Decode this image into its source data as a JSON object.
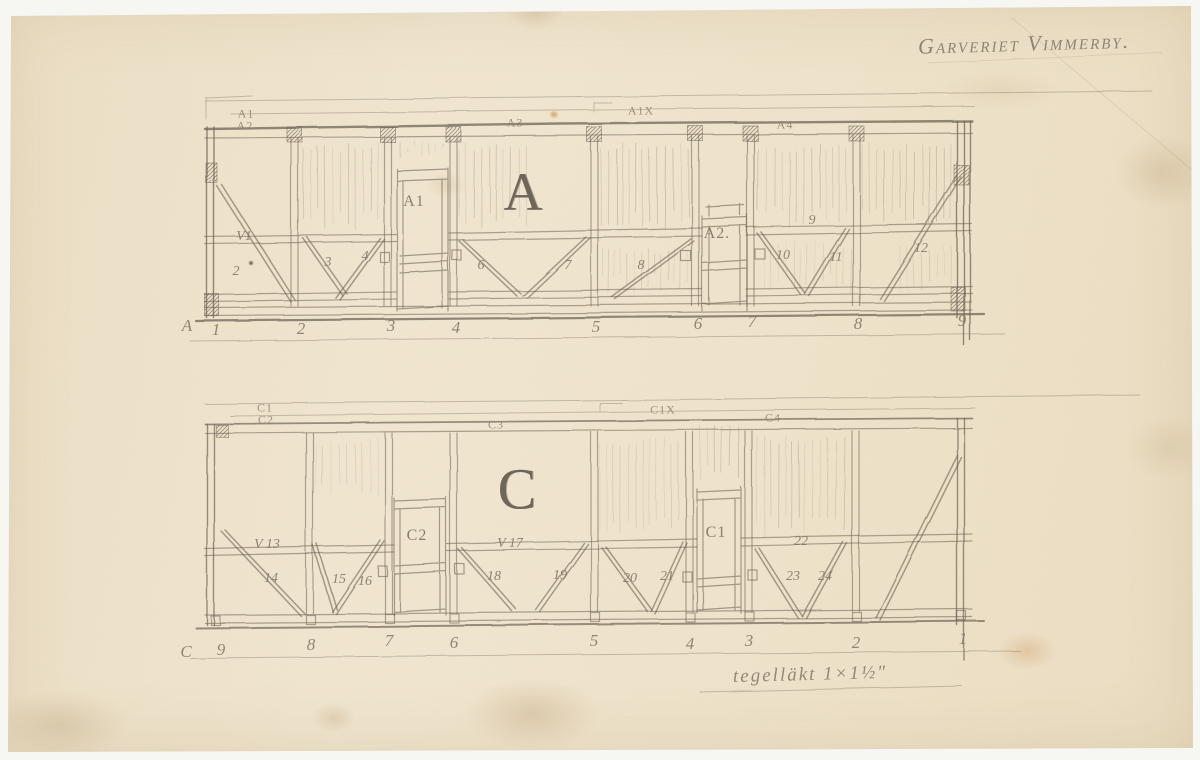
{
  "document": {
    "title": "Garveriet Vimmerby.",
    "annotation": "tegelläkt 1×1½″",
    "colors": {
      "paper": "#efe3cb",
      "pencil": "#6f6557",
      "background": "#f6f6f3"
    }
  },
  "elevation_a": {
    "big_letter": "A",
    "top_labels": [
      {
        "text": "A1",
        "x": 246,
        "y": 114
      },
      {
        "text": "A2",
        "x": 245,
        "y": 126
      },
      {
        "text": "A3",
        "x": 515,
        "y": 123
      },
      {
        "text": "A1X",
        "x": 641,
        "y": 111
      },
      {
        "text": "A4",
        "x": 785,
        "y": 125
      }
    ],
    "door_labels": [
      {
        "text": "A1",
        "x": 414,
        "y": 202
      },
      {
        "text": "A2.",
        "x": 717,
        "y": 234
      }
    ],
    "panel_labels": [
      {
        "text": "V1",
        "x": 244,
        "y": 237
      },
      {
        "text": "2",
        "x": 236,
        "y": 272
      },
      {
        "text": "3",
        "x": 328,
        "y": 263
      },
      {
        "text": "4",
        "x": 365,
        "y": 257
      },
      {
        "text": "6",
        "x": 481,
        "y": 266
      },
      {
        "text": "7",
        "x": 568,
        "y": 266
      },
      {
        "text": "8",
        "x": 641,
        "y": 266
      },
      {
        "text": "9",
        "x": 812,
        "y": 221
      },
      {
        "text": "10",
        "x": 783,
        "y": 256
      },
      {
        "text": "11",
        "x": 836,
        "y": 258
      },
      {
        "text": "12",
        "x": 921,
        "y": 249
      }
    ],
    "grid_labels": [
      {
        "text": "A",
        "x": 187,
        "y": 326
      },
      {
        "text": "1",
        "x": 216,
        "y": 330
      },
      {
        "text": "2",
        "x": 301,
        "y": 329
      },
      {
        "text": "3",
        "x": 391,
        "y": 326
      },
      {
        "text": "4",
        "x": 456,
        "y": 328
      },
      {
        "text": "5",
        "x": 596,
        "y": 327
      },
      {
        "text": "6",
        "x": 698,
        "y": 324
      },
      {
        "text": "7",
        "x": 752,
        "y": 322
      },
      {
        "text": "8",
        "x": 858,
        "y": 324
      },
      {
        "text": "9",
        "x": 962,
        "y": 321
      }
    ]
  },
  "elevation_c": {
    "big_letter": "C",
    "top_labels": [
      {
        "text": "C1",
        "x": 265,
        "y": 408
      },
      {
        "text": "C2",
        "x": 266,
        "y": 420
      },
      {
        "text": "C3",
        "x": 496,
        "y": 425
      },
      {
        "text": "C1X",
        "x": 663,
        "y": 410
      },
      {
        "text": "C4",
        "x": 773,
        "y": 418
      }
    ],
    "door_labels": [
      {
        "text": "C2",
        "x": 417,
        "y": 536
      },
      {
        "text": "C1",
        "x": 716,
        "y": 533
      }
    ],
    "panel_labels": [
      {
        "text": "V 13",
        "x": 267,
        "y": 545
      },
      {
        "text": "14",
        "x": 271,
        "y": 579
      },
      {
        "text": "15",
        "x": 339,
        "y": 580
      },
      {
        "text": "16",
        "x": 365,
        "y": 582
      },
      {
        "text": "V 17",
        "x": 510,
        "y": 544
      },
      {
        "text": "18",
        "x": 494,
        "y": 577
      },
      {
        "text": "19",
        "x": 560,
        "y": 576
      },
      {
        "text": "20",
        "x": 630,
        "y": 579
      },
      {
        "text": "21",
        "x": 667,
        "y": 577
      },
      {
        "text": "22",
        "x": 801,
        "y": 542
      },
      {
        "text": "23",
        "x": 793,
        "y": 577
      },
      {
        "text": "24",
        "x": 825,
        "y": 577
      }
    ],
    "grid_labels": [
      {
        "text": "C",
        "x": 186,
        "y": 652
      },
      {
        "text": "9",
        "x": 221,
        "y": 650
      },
      {
        "text": "8",
        "x": 311,
        "y": 645
      },
      {
        "text": "7",
        "x": 389,
        "y": 641
      },
      {
        "text": "6",
        "x": 454,
        "y": 643
      },
      {
        "text": "5",
        "x": 594,
        "y": 641
      },
      {
        "text": "4",
        "x": 690,
        "y": 644
      },
      {
        "text": "3",
        "x": 749,
        "y": 641
      },
      {
        "text": "2",
        "x": 856,
        "y": 643
      },
      {
        "text": "1",
        "x": 963,
        "y": 639
      }
    ]
  }
}
